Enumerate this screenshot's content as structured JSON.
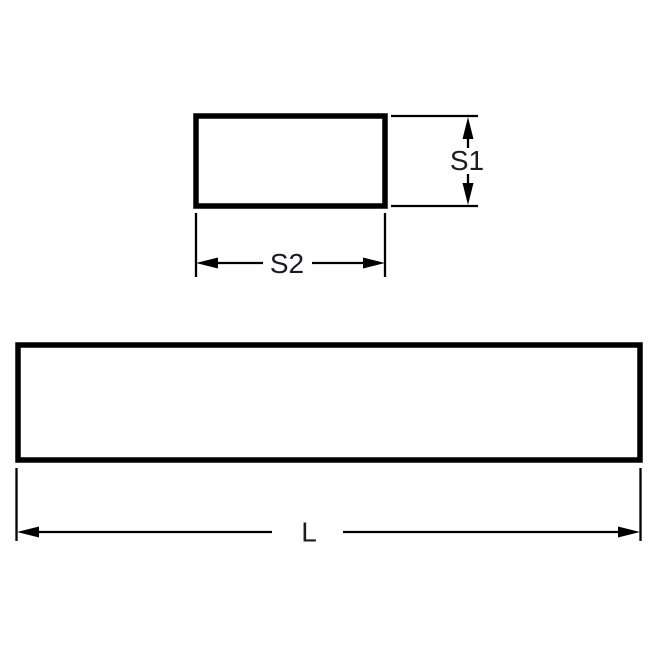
{
  "page": {
    "background": "#ffffff"
  },
  "drawing": {
    "kind": "technical-dimension-drawing",
    "line_color": "#000000",
    "label_color": "#1b1b24",
    "cross_section": {
      "height_label": "S1",
      "width_label": "S2"
    },
    "side_view": {
      "length_label": "L"
    }
  }
}
